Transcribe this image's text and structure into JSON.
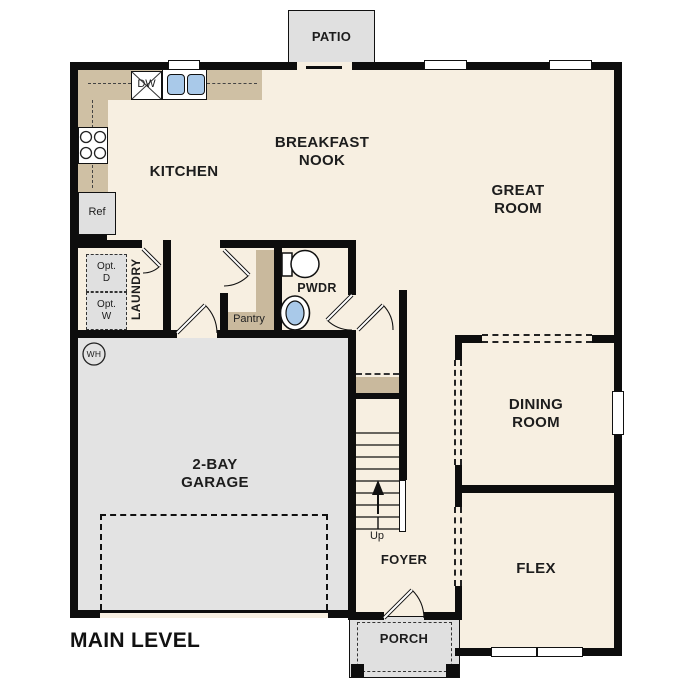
{
  "plan": {
    "title": "MAIN LEVEL",
    "rooms": {
      "patio": "PATIO",
      "breakfast_nook": [
        "BREAKFAST",
        "NOOK"
      ],
      "kitchen": "KITCHEN",
      "great_room": [
        "GREAT",
        "ROOM"
      ],
      "dining_room": [
        "DINING",
        "ROOM"
      ],
      "flex": "FLEX",
      "foyer": "FOYER",
      "garage": [
        "2-BAY",
        "GARAGE"
      ],
      "laundry": "LAUNDRY",
      "powder_room": "PWDR",
      "pantry": "Pantry",
      "porch": "PORCH"
    },
    "fixtures": {
      "dishwasher": "DW",
      "refrigerator": "Ref",
      "optional_dryer": [
        "Opt.",
        "D"
      ],
      "optional_washer": [
        "Opt.",
        "W"
      ],
      "water_heater": "WH",
      "stairs_direction": "Up"
    },
    "colors": {
      "floor": "#f7efe1",
      "garage_floor": "#e3e3e3",
      "outdoor_concrete": "#e0e0e0",
      "counter_tan": "#cfc0a4",
      "shelf_tan": "#c9b99d",
      "sink_blue": "#a9c9e9",
      "wall_black": "#0d0d0d"
    }
  }
}
